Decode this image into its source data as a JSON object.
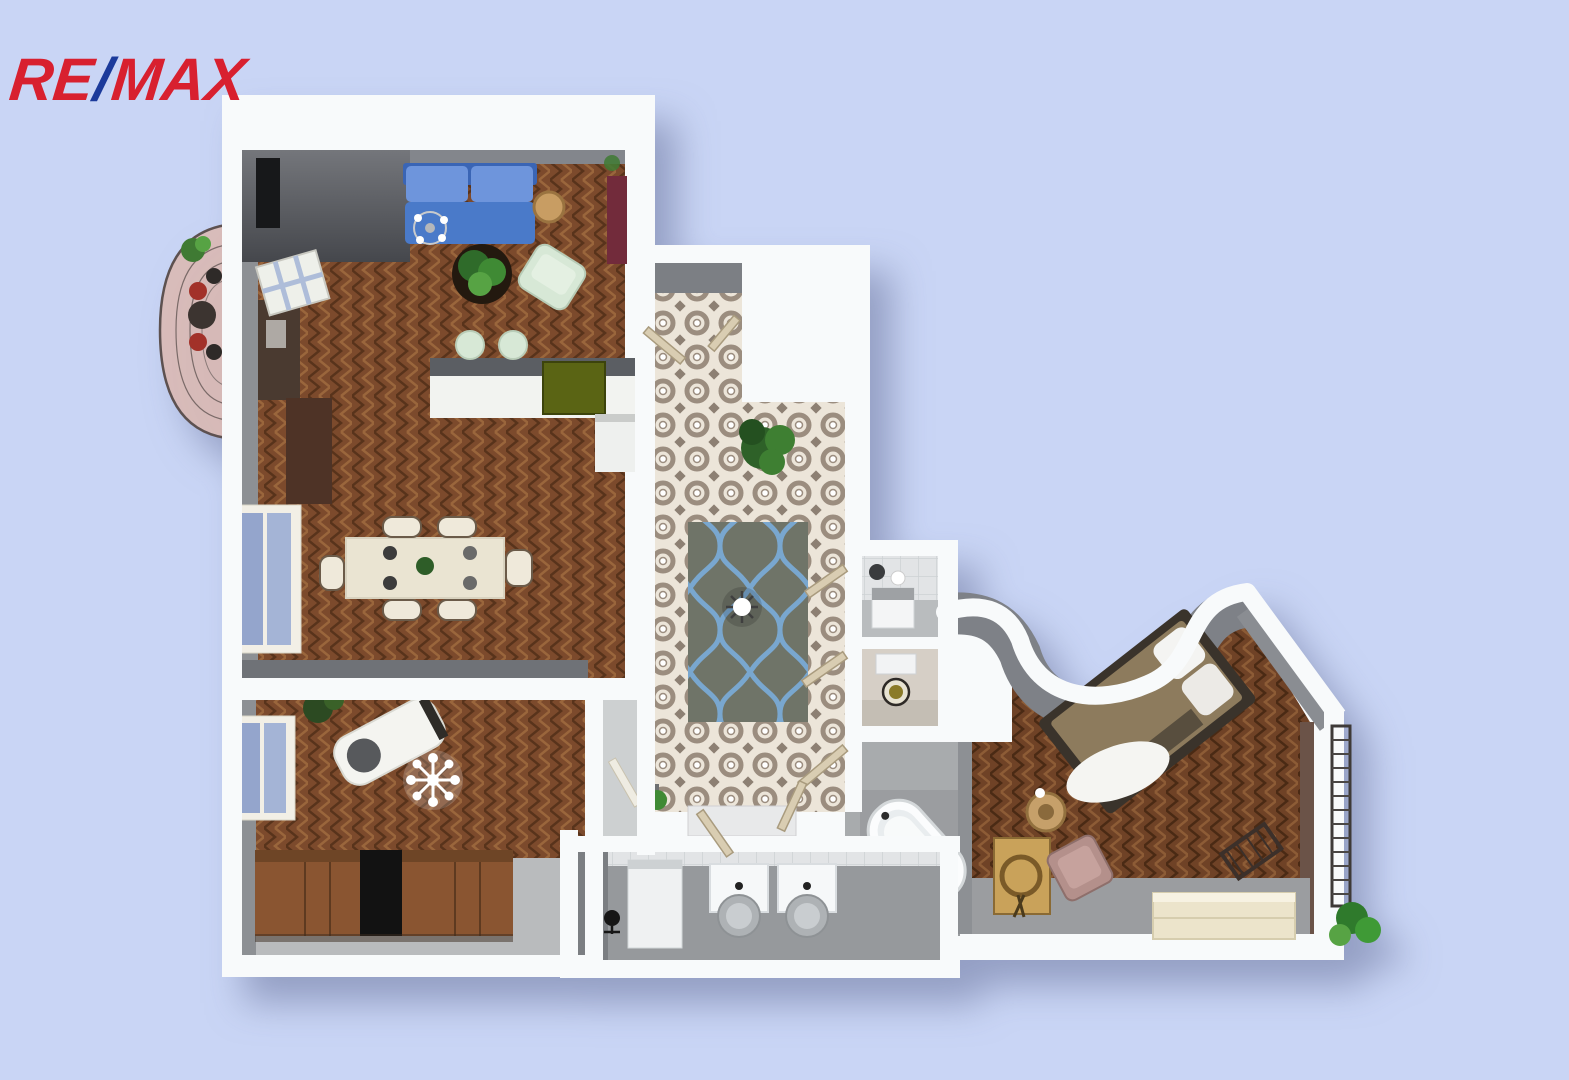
{
  "logo": {
    "re": "RE",
    "slash": "/",
    "max": "MAX"
  },
  "colors": {
    "bg": "#c9d5f5",
    "logo-red": "#d8202f",
    "logo-blue": "#1b3a9b",
    "wall-white": "#f8fafb",
    "wall-face": "#83868c",
    "wall-face-dark": "#4c4e54",
    "wood-base": "#7c4a2c",
    "wood-light": "#9a663c",
    "wood-dark": "#58331b",
    "tile-bg": "#ece5d9",
    "tile-ink": "#9b8d7f",
    "rug-base": "#6f7468",
    "rug-line": "#79a7cf",
    "sofa-blue": "#4a7ac9",
    "sofa-blue-light": "#6e95dc",
    "mint": "#d7e8d6",
    "cream": "#eae4d2",
    "maroon": "#722b3b",
    "wardrobe": "#8a5531",
    "floor-gray": "#9b9da0",
    "marble": "#e4e6e8",
    "pink-floor": "#d9bab6",
    "red-chair": "#a23129",
    "plant-green": "#3f7a33",
    "blanket": "#8d7b5d",
    "dresser": "#ece4cb",
    "pink-chair": "#b4908b"
  }
}
